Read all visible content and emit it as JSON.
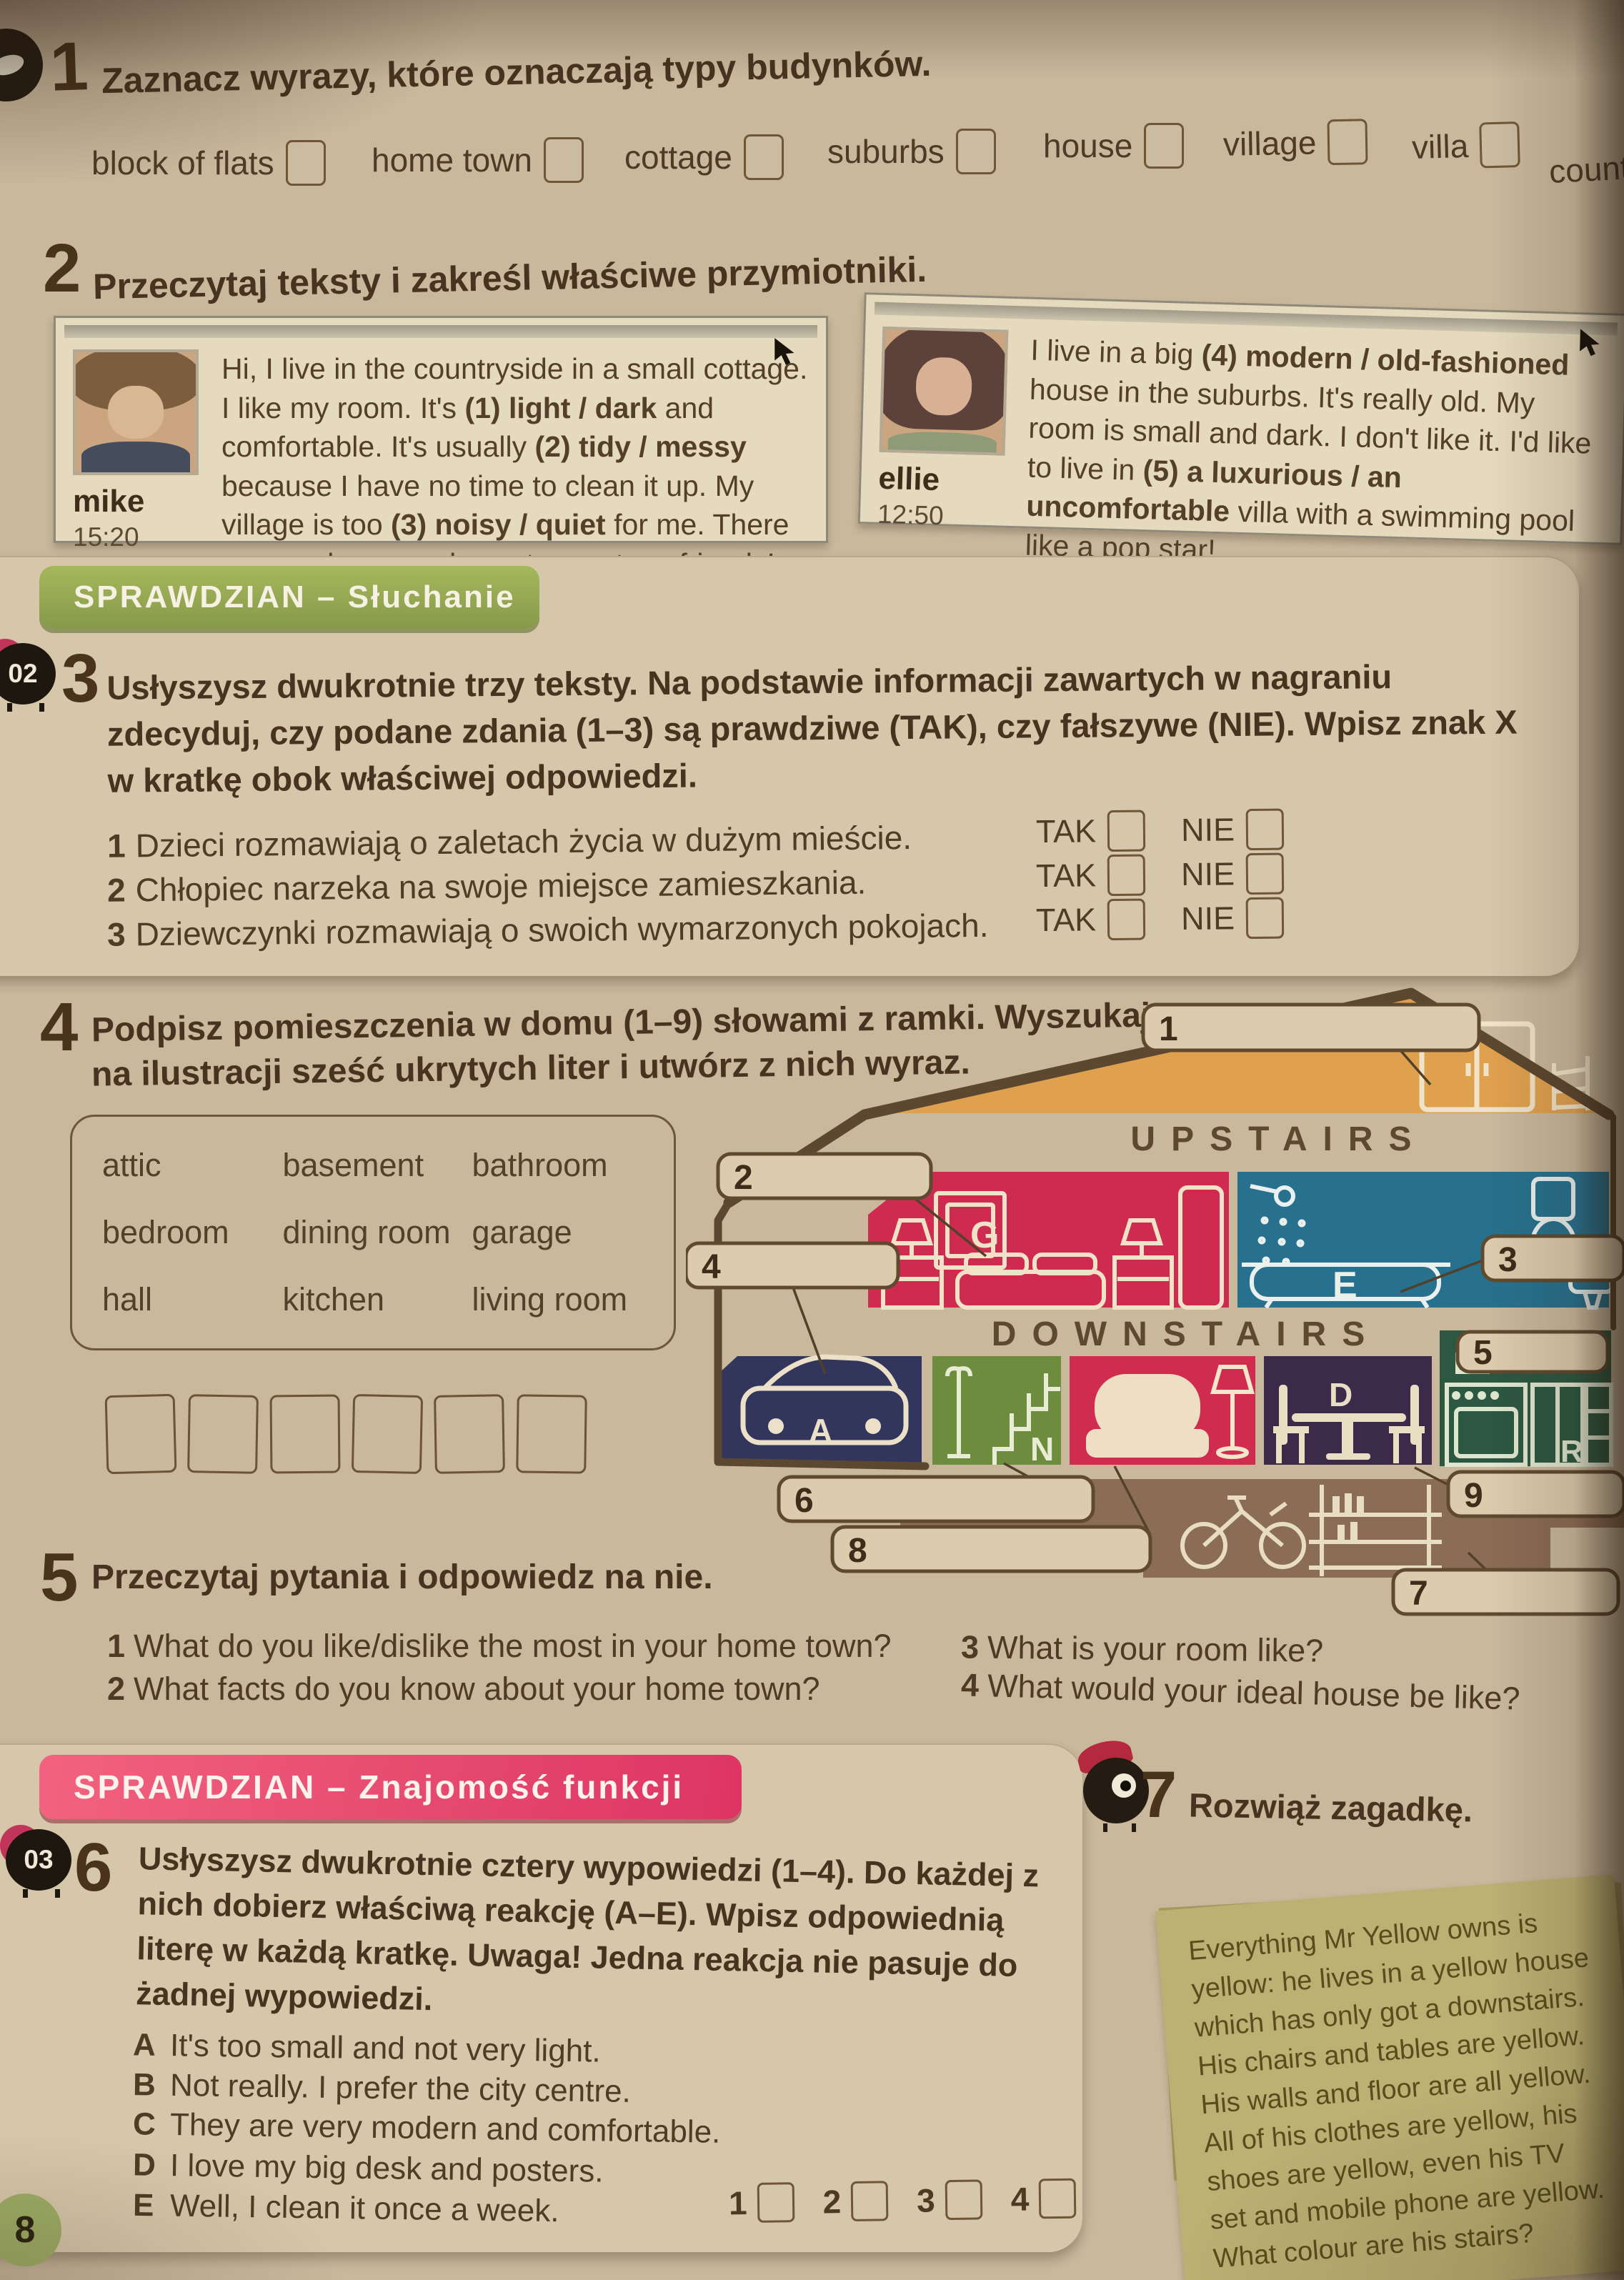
{
  "page_number": "8",
  "ex1": {
    "num": "1",
    "title": "Zaznacz wyrazy, które oznaczają typy budynków.",
    "words": [
      "block of flats",
      "home town",
      "cottage",
      "suburbs",
      "house",
      "village",
      "villa",
      "countryside"
    ]
  },
  "ex2": {
    "num": "2",
    "title": "Przeczytaj teksty i zakreśl właściwe przymiotniki.",
    "posts": [
      {
        "author": "mike",
        "time": "15:20",
        "segments": [
          {
            "t": "Hi, I live in the countryside in a small cottage. I like my room. It's "
          },
          {
            "t": "(1) light / dark",
            "b": true
          },
          {
            "t": " and comfortable. It's usually "
          },
          {
            "t": "(2) tidy / messy",
            "b": true
          },
          {
            "t": " because I have no time to clean it up. My village is too "
          },
          {
            "t": "(3) noisy / quiet",
            "b": true
          },
          {
            "t": " for me. There are no shops or places to meet my friends!"
          }
        ]
      },
      {
        "author": "ellie",
        "time": "12:50",
        "segments": [
          {
            "t": "I live in a big "
          },
          {
            "t": "(4) modern / old-fashioned",
            "b": true
          },
          {
            "t": " house in the suburbs. It's really old. My room is small and dark. I don't like it. I'd like to live in "
          },
          {
            "t": "(5) a luxurious / an uncomfortable",
            "b": true
          },
          {
            "t": " villa with a swimming pool like a pop star!"
          }
        ]
      }
    ]
  },
  "banner_listening": "SPRAWDZIAN – Słuchanie",
  "banner_functions": "SPRAWDZIAN – Znajomość funkcji",
  "ex3": {
    "num": "3",
    "audio": "02",
    "instruction": "Usłyszysz dwukrotnie trzy teksty. Na podstawie informacji zawartych w nagraniu zdecyduj, czy podane zdania (1–3) są prawdziwe (TAK), czy fałszywe (NIE). Wpisz znak X w kratkę obok właściwej odpowiedzi.",
    "tak": "TAK",
    "nie": "NIE",
    "items": [
      {
        "num": "1",
        "text": "Dzieci rozmawiają o zaletach życia w dużym mieście."
      },
      {
        "num": "2",
        "text": "Chłopiec narzeka na swoje miejsce zamieszkania."
      },
      {
        "num": "3",
        "text": "Dziewczynki rozmawiają o swoich wymarzonych pokojach."
      }
    ]
  },
  "ex4": {
    "num": "4",
    "title_line1": "Podpisz pomieszczenia w domu (1–9) słowami z ramki. Wyszukaj",
    "title_line2": "na ilustracji sześć ukrytych liter i utwórz z nich wyraz.",
    "words": [
      "attic",
      "basement",
      "bathroom",
      "bedroom",
      "dining room",
      "garage",
      "hall",
      "kitchen",
      "living room"
    ]
  },
  "house": {
    "upstairs": "UPSTAIRS",
    "downstairs": "DOWNSTAIRS",
    "labels": {
      "l1": "1",
      "l2": "2",
      "l3": "3",
      "l4": "4",
      "l5": "5",
      "l6": "6",
      "l7": "7",
      "l8": "8",
      "l9": "9"
    },
    "letters": {
      "g": "G",
      "e": "E",
      "a": "A",
      "n": "N",
      "d": "D",
      "r": "R"
    }
  },
  "ex5": {
    "num": "5",
    "title": "Przeczytaj pytania i odpowiedz na nie.",
    "questions": [
      {
        "num": "1",
        "text": "What do you like/dislike the most in your home town?"
      },
      {
        "num": "2",
        "text": "What facts do you know about your home town?"
      },
      {
        "num": "3",
        "text": "What is your room like?"
      },
      {
        "num": "4",
        "text": "What would your ideal house be like?"
      }
    ]
  },
  "ex6": {
    "num": "6",
    "audio": "03",
    "instruction": "Usłyszysz dwukrotnie cztery wypowiedzi (1–4). Do każdej z nich dobierz właściwą reakcję (A–E). Wpisz odpowiednią literę w każdą kratkę. Uwaga! Jedna reakcja nie pasuje do żadnej wypowiedzi.",
    "options": [
      {
        "letter": "A",
        "text": "It's too small and not very light."
      },
      {
        "letter": "B",
        "text": "Not really. I prefer the city centre."
      },
      {
        "letter": "C",
        "text": "They are very modern and comfortable."
      },
      {
        "letter": "D",
        "text": "I love my big desk and posters."
      },
      {
        "letter": "E",
        "text": "Well, I clean it once a week."
      }
    ],
    "answers": [
      "1",
      "2",
      "3",
      "4"
    ]
  },
  "ex7": {
    "num": "7",
    "title": "Rozwiąż zagadkę.",
    "riddle": "Everything Mr Yellow owns is yellow: he lives in a yellow house which has only got a downstairs. His chairs and tables are yellow. His walls and floor are all yellow. All of his clothes are yellow, his shoes are yellow, even his TV set and mobile phone are yellow. What colour are his stairs?"
  }
}
